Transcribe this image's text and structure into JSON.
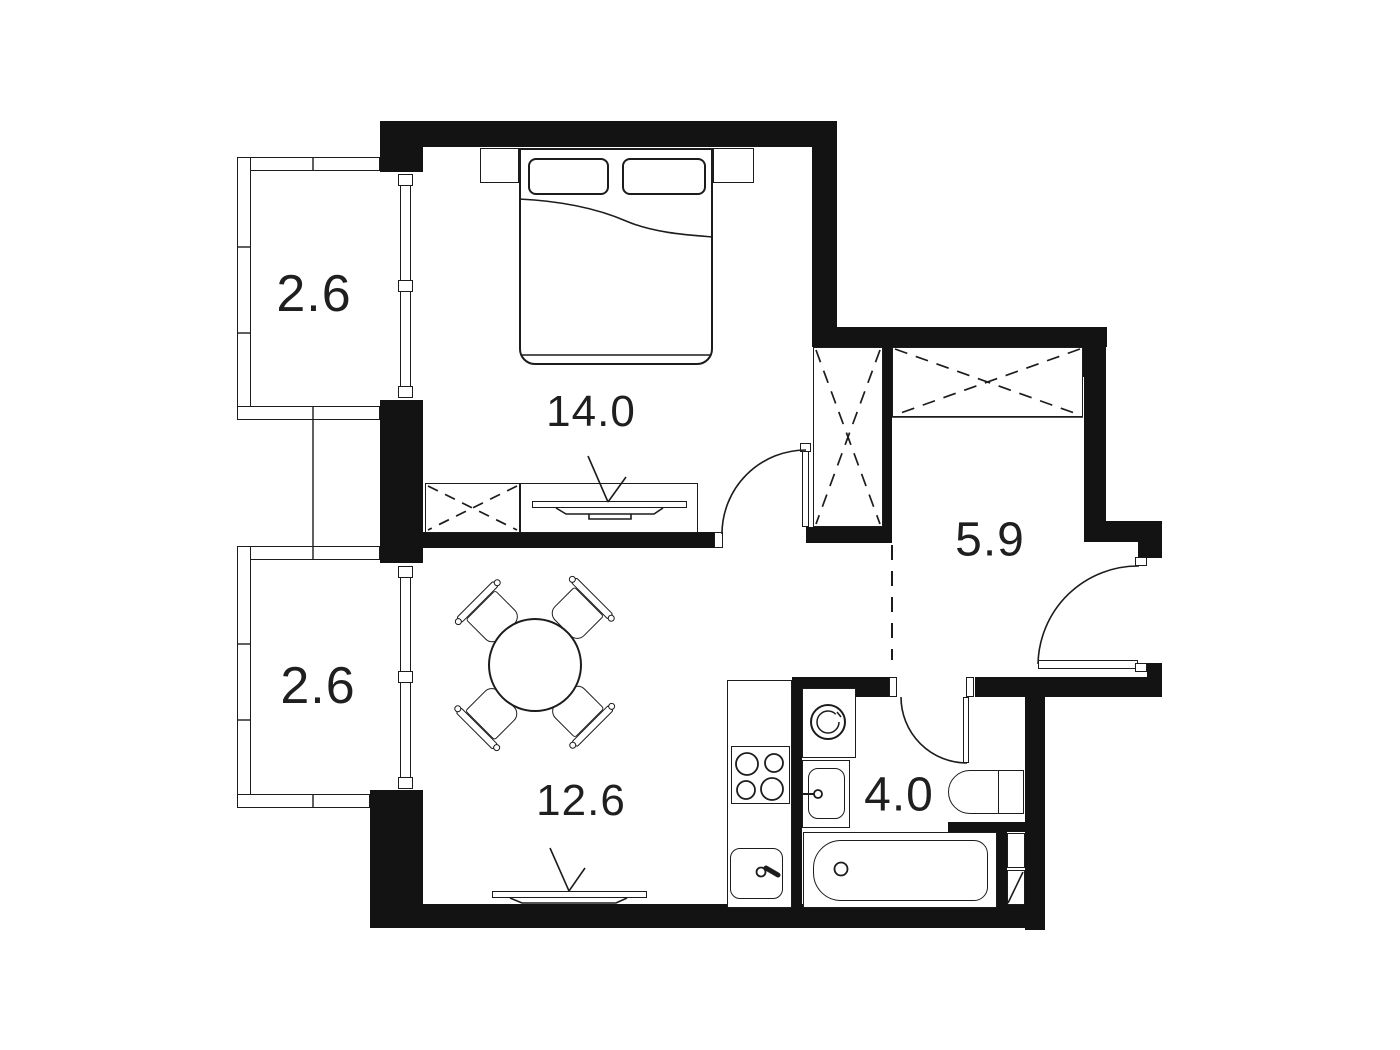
{
  "colors": {
    "wall": "#131313",
    "line": "#1c1c1c",
    "background": "#ffffff",
    "label": "#1f1f1f"
  },
  "rooms": [
    {
      "name": "balcony-upper",
      "area": "2.6"
    },
    {
      "name": "bedroom",
      "area": "14.0"
    },
    {
      "name": "balcony-lower",
      "area": "2.6"
    },
    {
      "name": "hallway",
      "area": "5.9"
    },
    {
      "name": "living-room-kitchen",
      "area": "12.6"
    },
    {
      "name": "bathroom",
      "area": "4.0"
    }
  ],
  "furniture_icons": [
    "double-bed",
    "pillow",
    "nightstand",
    "dresser",
    "tv-console",
    "tv-icon",
    "wardrobe",
    "dining-table",
    "chair",
    "kitchen-counter",
    "stove-icon",
    "kitchen-sink-icon",
    "washing-machine-icon",
    "bathroom-sink-icon",
    "toilet-icon",
    "bathtub-icon",
    "duct-shaft",
    "door-swing"
  ]
}
